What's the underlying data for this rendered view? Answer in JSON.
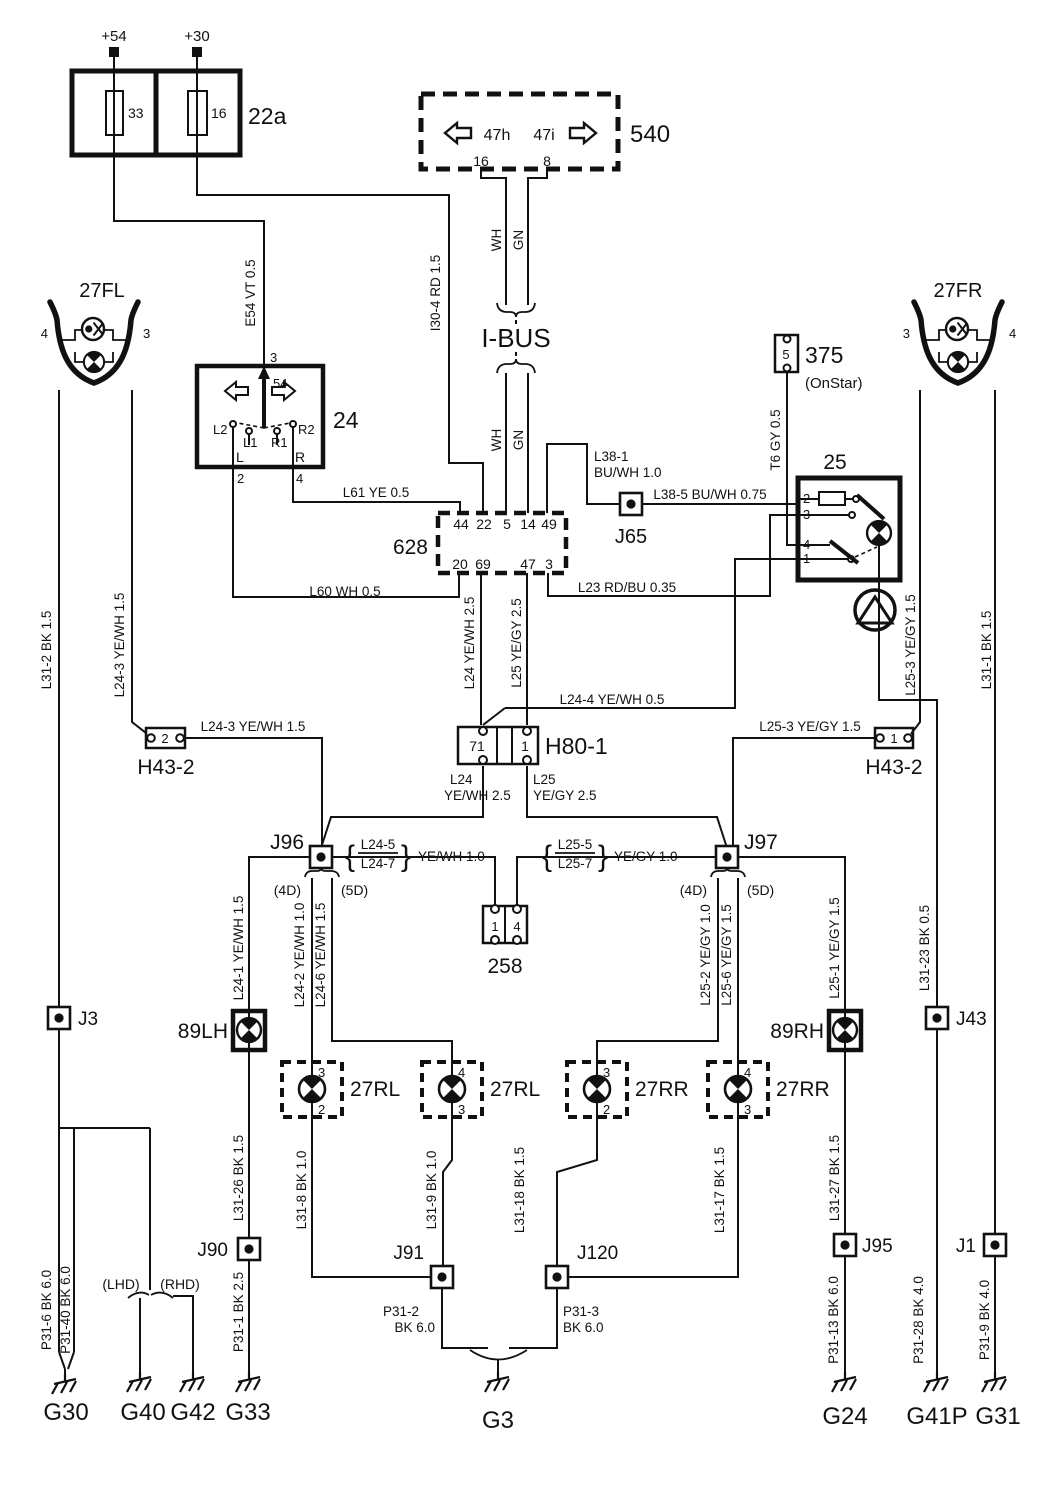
{
  "fusebox22a": {
    "label": "22a",
    "terminal_left": "+54",
    "terminal_right": "+30",
    "fuse_left": "33",
    "fuse_right": "16"
  },
  "module540": {
    "label": "540",
    "left_signal": "47h",
    "right_signal": "47i",
    "pin_left": "16",
    "pin_right": "8"
  },
  "ibus": {
    "label": "I-BUS",
    "wh_top": "WH",
    "gn_top": "GN",
    "wh_bot": "WH",
    "gn_bot": "GN"
  },
  "lamp27fl": {
    "label": "27FL",
    "pin_left": "4",
    "pin_right": "3"
  },
  "lamp27fr": {
    "label": "27FR",
    "pin_left": "3",
    "pin_right": "4"
  },
  "switch24": {
    "label": "24",
    "pin_top": "3",
    "t54": "54",
    "l2": "L2",
    "l1": "L1",
    "r1": "R1",
    "r2": "R2",
    "l": "L",
    "r": "R",
    "pin_left": "2",
    "pin_right": "4"
  },
  "conn628": {
    "label": "628",
    "top": [
      "44",
      "22",
      "5",
      "14",
      "49"
    ],
    "bottom": [
      "20",
      "69",
      "47",
      "3"
    ]
  },
  "onstar375": {
    "label": "375",
    "sub": "(OnStar)",
    "pin": "5"
  },
  "switch25": {
    "label": "25",
    "pins": [
      "2",
      "3",
      "4",
      "1"
    ]
  },
  "h43l": {
    "label": "H43-2",
    "pin": "2"
  },
  "h43r": {
    "label": "H43-2",
    "pin": "1"
  },
  "h80": {
    "label": "H80-1",
    "pin_left": "71",
    "pin_right": "1",
    "wl1": "L24",
    "wl2": "YE/WH 2.5",
    "wr1": "L25",
    "wr2": "YE/GY 2.5"
  },
  "j96grp": {
    "label": "J96",
    "d4": "(4D)",
    "d5": "(5D)",
    "brl": "{",
    "brr": "}",
    "w1": "L24-5",
    "w2": "L24-7",
    "spec": "YE/WH  1.0"
  },
  "j97grp": {
    "label": "J97",
    "d4": "(4D)",
    "d5": "(5D)",
    "brl": "{",
    "brr": "}",
    "w1": "L25-5",
    "w2": "L25-7",
    "spec": "YE/GY  1.0"
  },
  "conn258": {
    "label": "258",
    "pin1": "1",
    "pin4": "4"
  },
  "lamp89lh": {
    "label": "89LH"
  },
  "lamp89rh": {
    "label": "89RH"
  },
  "rear_lamps": [
    {
      "label": "27RL",
      "top": "3",
      "bottom": "2"
    },
    {
      "label": "27RL",
      "top": "4",
      "bottom": "3"
    },
    {
      "label": "27RR",
      "top": "3",
      "bottom": "2"
    },
    {
      "label": "27RR",
      "top": "4",
      "bottom": "3"
    }
  ],
  "junctions": {
    "j65": "J65",
    "j96": "J96",
    "j97": "J97",
    "j3": "J3",
    "j43": "J43",
    "j90": "J90",
    "j91": "J91",
    "j120": "J120",
    "j95": "J95",
    "j1": "J1"
  },
  "variants": {
    "lhd": "(LHD)",
    "rhd": "(RHD)"
  },
  "grounds": {
    "g30": "G30",
    "g40": "G40",
    "g42": "G42",
    "g33": "G33",
    "g3": "G3",
    "g24": "G24",
    "g41p": "G41P",
    "g31": "G31"
  },
  "wires": {
    "e54": "E54  VT  0.5",
    "i30_4": "I30-4  RD  1.5",
    "l61": "L61   YE   0.5",
    "l60": "L60   WH   0.5",
    "l38_1a": "L38-1",
    "l38_1b": "BU/WH  1.0",
    "l38_5": "L38-5   BU/WH    0.75",
    "t6": "T6  GY  0.5",
    "l23": "L23   RD/BU  0.35",
    "l24_4": "L24-4   YE/WH  0.5",
    "l24v": "L24  YE/WH  2.5",
    "l25v": "L25  YE/GY  2.5",
    "l24_3v": "L24-3  YE/WH  1.5",
    "l24_3h": "L24-3   YE/WH   1.5",
    "l25_3v": "L25-3  YE/GY  1.5",
    "l25_3h": "L25-3   YE/GY   1.5",
    "l31_2": "L31-2  BK  1.5",
    "l31_1": "L31-1  BK  1.5",
    "l24_1": "L24-1  YE/WH  1.5",
    "l24_2": "L24-2  YE/WH  1.0",
    "l24_6": "L24-6  YE/WH  1.5",
    "l25_1": "L25-1  YE/GY  1.5",
    "l25_2": "L25-2  YE/GY  1.0",
    "l25_6": "L25-6  YE/GY  1.5",
    "l31_23": "L31-23  BK  0.5",
    "l31_26": "L31-26  BK  1.5",
    "l31_27": "L31-27  BK  1.5",
    "l31_8": "L31-8  BK  1.0",
    "l31_9": "L31-9  BK  1.0",
    "l31_18": "L31-18  BK  1.5",
    "l31_17": "L31-17  BK  1.5",
    "p31_6": "P31-6  BK  6.0",
    "p31_40": "P31-40  BK  6.0",
    "p31_1": "P31-1  BK  2.5",
    "p31_2a": "P31-2",
    "p31_2b": "BK  6.0",
    "p31_3a": "P31-3",
    "p31_3b": "BK  6.0",
    "p31_13": "P31-13  BK  6.0",
    "p31_28": "P31-28  BK  4.0",
    "p31_9": "P31-9  BK  4.0",
    "wh": "WH",
    "gn": "GN"
  }
}
